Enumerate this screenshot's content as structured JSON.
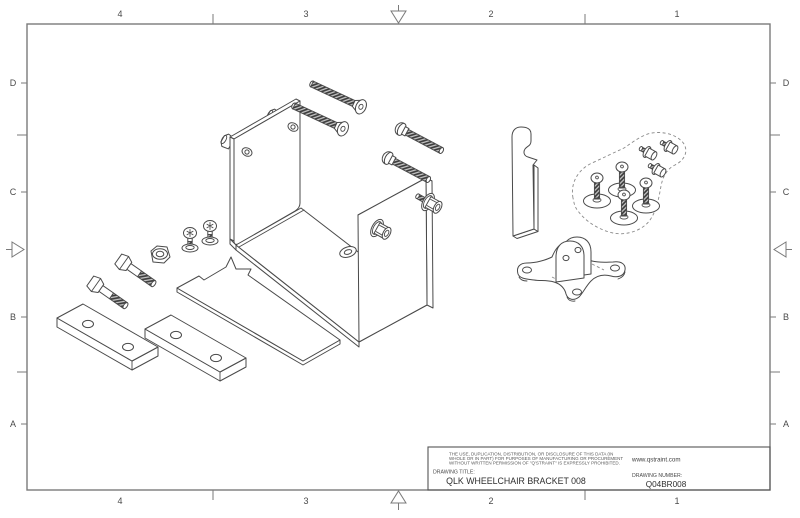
{
  "sheet": {
    "zone_columns": [
      "4",
      "3",
      "2",
      "1"
    ],
    "zone_rows": [
      "D",
      "C",
      "B",
      "A"
    ]
  },
  "title_block": {
    "legal_lines": [
      "THE USE, DUPLICATION, DISTRIBUTION, OR DISCLOSURE OF THIS DATA (IN",
      "WHOLE OR IN PART) FOR PURPOSES OF MANUFACTURING OR PROCUREMENT",
      "WITHOUT WRITTEN PERMISSION OF \"Q'STRAINT\" IS EXPRESSLY PROHIBITED."
    ],
    "website": "www.qstraint.com",
    "drawing_title_label": "DRAWING TITLE:",
    "drawing_title": "QLK WHEELCHAIR BRACKET 008",
    "drawing_number_label": "DRAWING NUMBER:",
    "drawing_number": "Q04BR008"
  },
  "colors": {
    "line": "#4a4a4a",
    "frame": "#7a7a7a",
    "thread_hatch": "#383838",
    "text": "#3f3f3f"
  }
}
